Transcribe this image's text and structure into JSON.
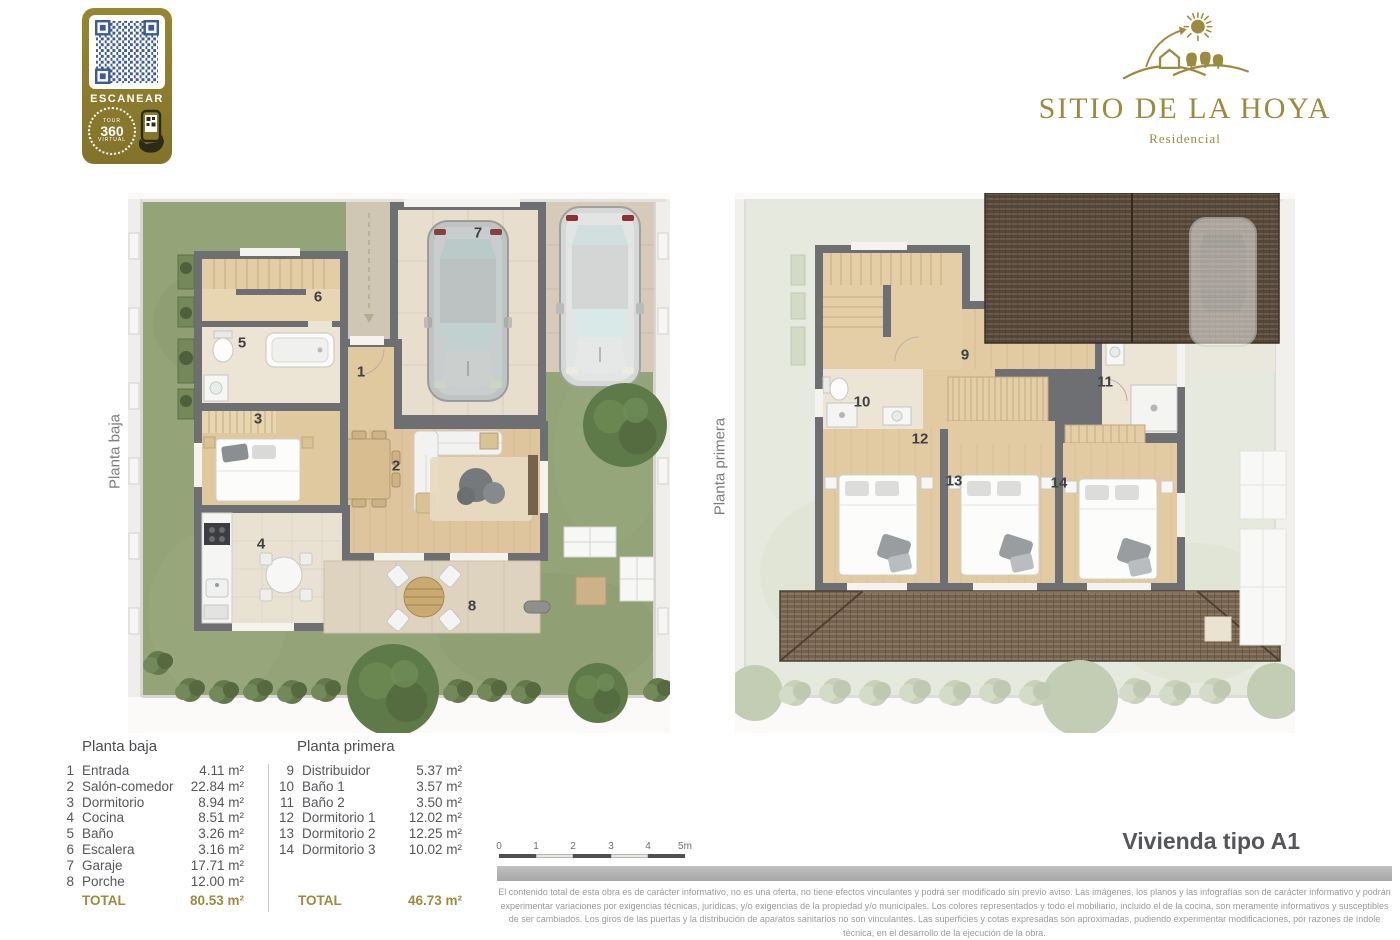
{
  "qr_badge": {
    "scan_label": "ESCANEAR",
    "tour_word": "TOUR",
    "tour_number": "360",
    "tour_type": "VIRTUAL"
  },
  "logo": {
    "title": "SITIO DE LA HOYA",
    "subtitle": "Residencial"
  },
  "plans": {
    "baja": {
      "side_label": "Planta baja",
      "markers": [
        "1",
        "2",
        "3",
        "4",
        "5",
        "6",
        "7",
        "8"
      ]
    },
    "primera": {
      "side_label": "Planta primera",
      "markers": [
        "9",
        "10",
        "11",
        "12",
        "13",
        "14"
      ]
    }
  },
  "legend": {
    "baja": {
      "title": "Planta baja",
      "rows": [
        {
          "num": "1",
          "name": "Entrada",
          "area": "4.11 m²"
        },
        {
          "num": "2",
          "name": "Salón-comedor",
          "area": "22.84 m²"
        },
        {
          "num": "3",
          "name": "Dormitorio",
          "area": "8.94 m²"
        },
        {
          "num": "4",
          "name": "Cocina",
          "area": "8.51 m²"
        },
        {
          "num": "5",
          "name": "Baño",
          "area": "3.26 m²"
        },
        {
          "num": "6",
          "name": "Escalera",
          "area": "3.16 m²"
        },
        {
          "num": "7",
          "name": "Garaje",
          "area": "17.71 m²"
        },
        {
          "num": "8",
          "name": "Porche",
          "area": "12.00 m²"
        }
      ],
      "total_label": "TOTAL",
      "total_area": "80.53 m²"
    },
    "primera": {
      "title": "Planta primera",
      "rows": [
        {
          "num": "9",
          "name": "Distribuidor",
          "area": "5.37 m²"
        },
        {
          "num": "10",
          "name": "Baño 1",
          "area": "3.57 m²"
        },
        {
          "num": "11",
          "name": "Baño 2",
          "area": "3.50 m²"
        },
        {
          "num": "12",
          "name": "Dormitorio 1",
          "area": "12.02 m²"
        },
        {
          "num": "13",
          "name": "Dormitorio 2",
          "area": "12.25 m²"
        },
        {
          "num": "14",
          "name": "Dormitorio 3",
          "area": "10.02 m²"
        }
      ],
      "total_label": "TOTAL",
      "total_area": "46.73 m²"
    }
  },
  "scale_bar": {
    "ticks": [
      "0",
      "1",
      "2",
      "3",
      "4",
      "5m"
    ]
  },
  "unit_title": "Vivienda tipo A1",
  "disclaimer": "El contenido total de esta obra es de carácter informativo, no es una oferta, no tiene efectos vinculantes y podrá ser modificado sin previo aviso. Las imágenes, los planos y las infografías son de carácter informativo y podrán experimentar variaciones por exigencias técnicas, jurídicas, y/o exigencias de la propiedad y/o municipales. Los colores representados y todo el mobiliario, incluido el de la cocina, son meramente informativos y susceptibles de ser cambiados. Los giros de las puertas y la distribución de aparatos sanitarios no son vinculantes. Las superficies y cotas expresadas son aproximadas, pudiendo experimentar modificaciones, por razones de índole técnica, en el desarrollo de la ejecución de la obra.",
  "colors": {
    "brand_gold": "#9c8b3e",
    "badge_gold": "#8e7d31",
    "qr_blue": "#3d5a99",
    "grass_green": "#94a478",
    "faded_green": "#e6e9dd",
    "wall_gray": "#6e6f72",
    "wood_floor": "#dfc59e",
    "tile_floor": "#ece4d5",
    "driveway_beige": "#d5cbb8",
    "roof_brown": "#55463a",
    "text_gray": "#55565a",
    "total_gold": "#9c8b3e",
    "disclaimer_gray": "#9a9a9a",
    "footer_bar_gray": "#b3b3b3"
  }
}
